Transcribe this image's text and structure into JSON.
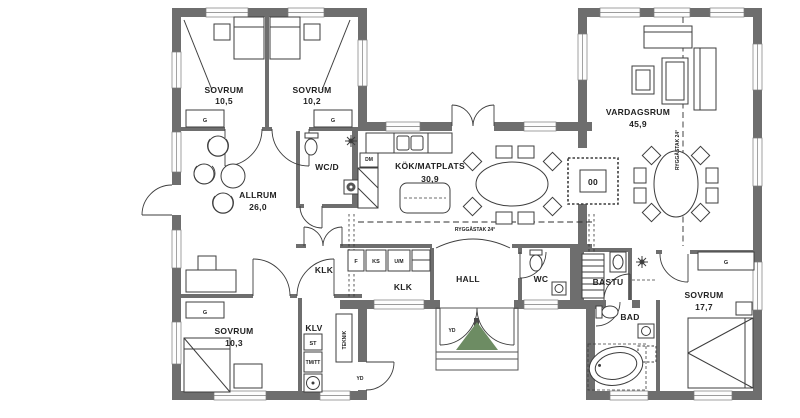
{
  "plan": {
    "type": "residential-floor-plan",
    "colors": {
      "wall": "#6e6e6e",
      "line": "#3d3d3d",
      "tree_green": "#6d8c63",
      "background": "#ffffff"
    },
    "rooms": [
      {
        "id": "sovrum-1",
        "name": "SOVRUM",
        "area": "10,5"
      },
      {
        "id": "sovrum-2",
        "name": "SOVRUM",
        "area": "10,2"
      },
      {
        "id": "allrum",
        "name": "ALLRUM",
        "area": "26,0"
      },
      {
        "id": "wcd",
        "name": "WC/D",
        "area": ""
      },
      {
        "id": "kok",
        "name": "KÖK/MATPLATS",
        "area": "30,9"
      },
      {
        "id": "vardagsrum",
        "name": "VARDAGSRUM",
        "area": "45,9"
      },
      {
        "id": "klk-1",
        "name": "KLK",
        "area": ""
      },
      {
        "id": "klk-2",
        "name": "KLK",
        "area": ""
      },
      {
        "id": "hall",
        "name": "HALL",
        "area": ""
      },
      {
        "id": "wc",
        "name": "WC",
        "area": ""
      },
      {
        "id": "bastu",
        "name": "BASTU",
        "area": ""
      },
      {
        "id": "bad",
        "name": "BAD",
        "area": ""
      },
      {
        "id": "sovrum-3",
        "name": "SOVRUM",
        "area": "17,7"
      },
      {
        "id": "sovrum-4",
        "name": "SOVRUM",
        "area": "10,3"
      },
      {
        "id": "klv",
        "name": "KLV",
        "area": ""
      }
    ],
    "labels": {
      "ridge": "RYGGÅSTAK 24°",
      "teknik": "TEKNIK",
      "wardrobe": "G",
      "freezer": "F",
      "fridge": "KS",
      "oven_micro": "U/M",
      "cleaning": "ST",
      "washer_dryer": "TM/TT",
      "dishwasher": "DM",
      "exterior_door": "YD",
      "fireplace": "00"
    }
  }
}
